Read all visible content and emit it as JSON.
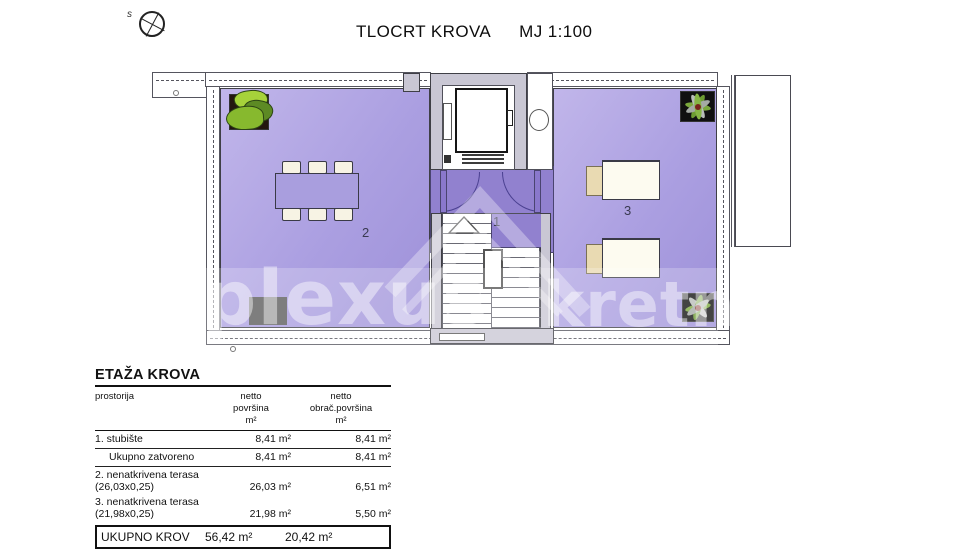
{
  "header": {
    "title": "TLOCRT KROVA",
    "scale": "MJ 1:100",
    "compass_label": "s"
  },
  "plan": {
    "room_labels": {
      "stairs": "1",
      "terrace_left": "2",
      "terrace_right": "3"
    },
    "colors": {
      "terrace_purple": "#ab9fe1",
      "door_area_purple": "#9181cf",
      "wall_gray": "#c9c7d4",
      "outline": "#3f3f46",
      "lounger_white": "#fdfbf0",
      "lounger_beige": "#e9dab2",
      "plant_green": "#7ab520",
      "mat_gray": "#5a5a5a"
    }
  },
  "watermark": {
    "left": "plexus",
    "right": "kretnin"
  },
  "area_table": {
    "title": "ETAŽA KROVA",
    "col_headers": {
      "c1": "prostorija",
      "c2": "netto\npovršina\nm²",
      "c3": "netto\nobrač.površina\nm²"
    },
    "rows": [
      {
        "name": "1. stubište",
        "netto": "8,41 m²",
        "obracun": "8,41 m²"
      },
      {
        "name": "Ukupno zatvoreno",
        "netto": "8,41 m²",
        "obracun": "8,41 m²"
      },
      {
        "name": "2. nenatkrivena terasa (26,03x0,25)",
        "netto": "26,03 m²",
        "obracun": "6,51 m²"
      },
      {
        "name": "3. nenatkrivena terasa (21,98x0,25)",
        "netto": "21,98 m²",
        "obracun": "5,50 m²"
      }
    ],
    "total": {
      "name": "UKUPNO KROV",
      "netto": "56,42 m²",
      "obracun": "20,42 m²"
    }
  }
}
